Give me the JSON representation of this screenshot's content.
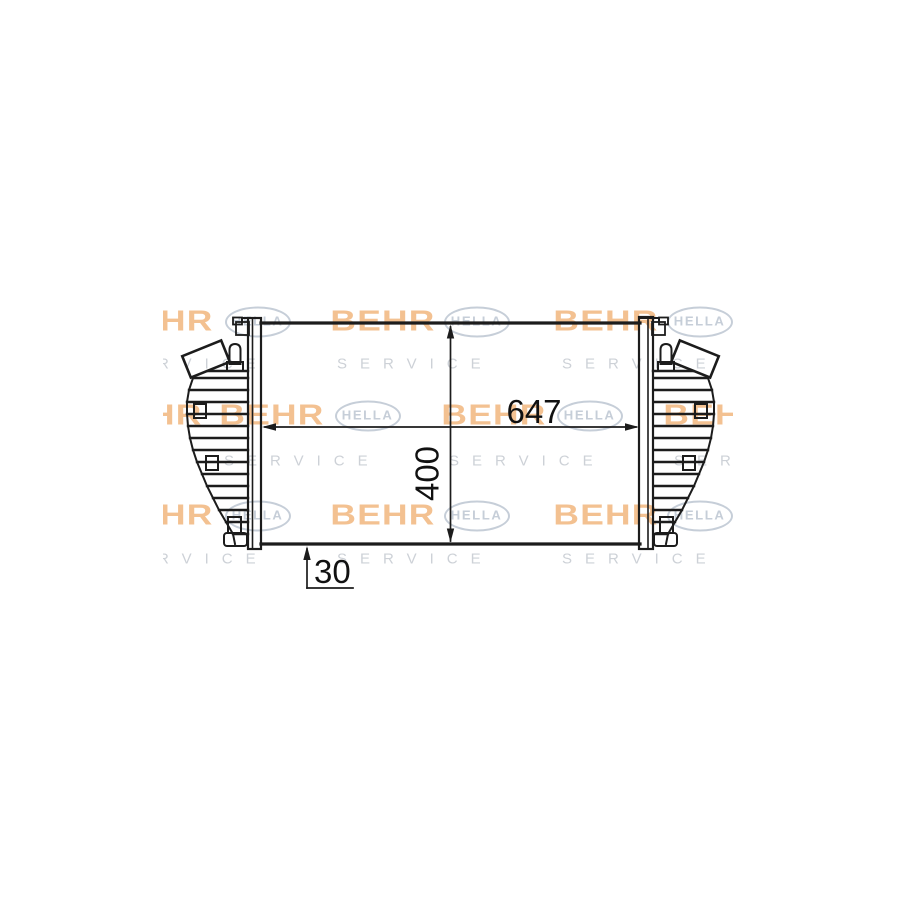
{
  "drawing": {
    "kind": "technical-line-drawing",
    "subject": "intercooler-front-view",
    "line_color": "#1c1c1c",
    "background": "#ffffff"
  },
  "dimensions": {
    "width": {
      "value": "647"
    },
    "height": {
      "value": "400"
    },
    "depth": {
      "value": "30"
    }
  },
  "watermark": {
    "behr_text": "BEHR",
    "hella_text": "HELLA",
    "service_text": "SERVICE",
    "colors": {
      "behr": "#ed9c4f",
      "hella": "#bdc6d2",
      "service": "#c8cdd3"
    },
    "logo_rows": [
      {
        "y": 322,
        "behr": [
          161,
          383,
          606
        ],
        "hella": [
          258,
          477,
          700
        ]
      },
      {
        "y": 416,
        "behr": [
          150,
          272,
          494,
          716
        ],
        "hella": [
          368,
          590
        ]
      },
      {
        "y": 516,
        "behr": [
          161,
          383,
          606
        ],
        "hella": [
          258,
          477,
          700
        ]
      }
    ],
    "service_rows": [
      {
        "y": 364,
        "starts": [
          112,
          337,
          562
        ]
      },
      {
        "y": 461,
        "starts": [
          224,
          449,
          674
        ]
      },
      {
        "y": 559,
        "starts": [
          112,
          337,
          562
        ]
      }
    ]
  }
}
